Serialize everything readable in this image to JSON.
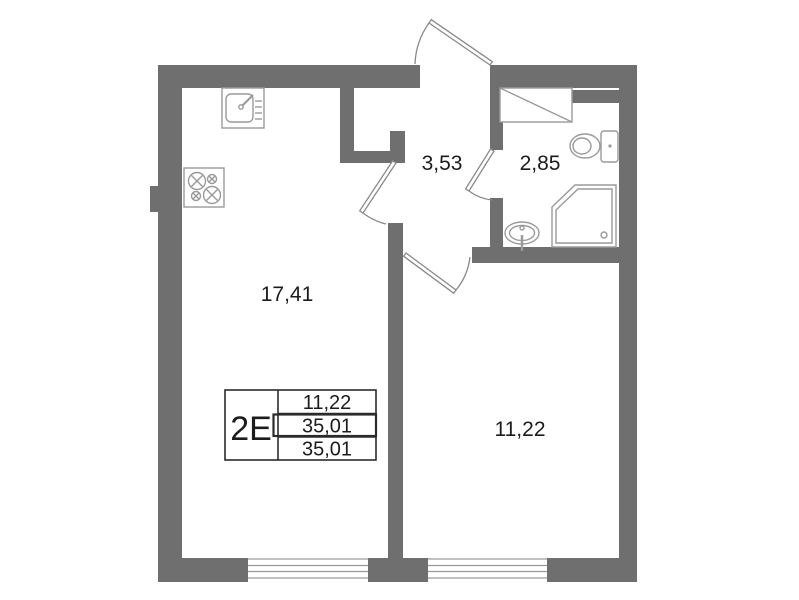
{
  "colors": {
    "wall": "#6f6f6f",
    "fixture_line": "#9a9a9a",
    "door_line": "#8a8a8a",
    "window_line": "#9a9a9a",
    "text": "#1c1c1c",
    "table_border": "#2b2b2b",
    "background": "#ffffff"
  },
  "plan": {
    "unit_label": "2Е",
    "area_table": {
      "rows": [
        "11,22",
        "35,01",
        "35,01"
      ]
    },
    "room_labels": {
      "living_kitchen": "17,41",
      "hallway": "3,53",
      "bathroom": "2,85",
      "bedroom": "11,22"
    },
    "fixtures": [
      "kitchen-sink",
      "stove",
      "washing-machine",
      "toilet",
      "shower",
      "washbasin"
    ]
  }
}
